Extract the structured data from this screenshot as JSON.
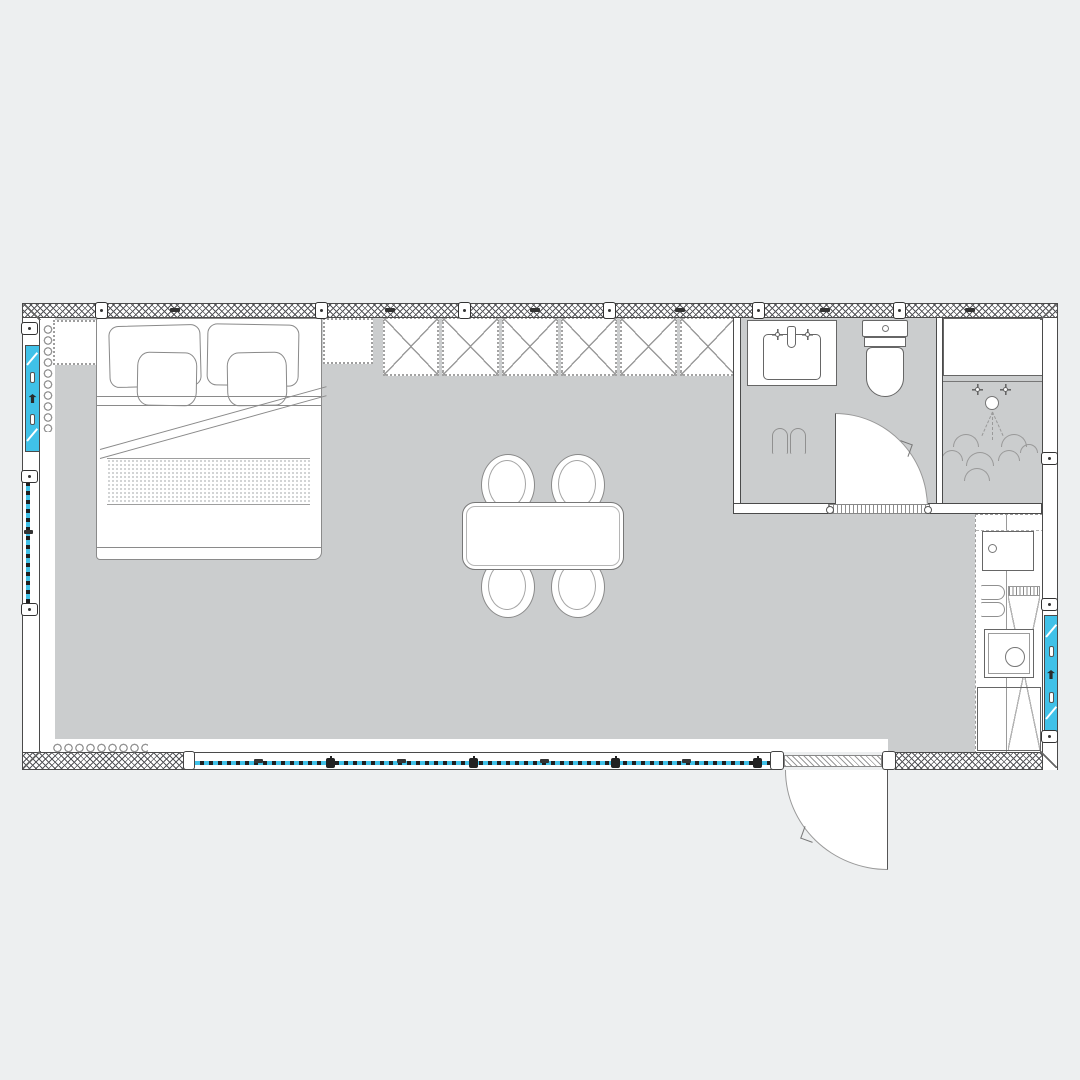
{
  "app": {
    "type": "architectural-floor-plan",
    "description": "Top-down studio / container-home floor plan with bedroom-living area, bathroom, shower room and kitchen strip"
  },
  "colors": {
    "page_bg": "#edeff0",
    "floor_fill": "#cbcdce",
    "window_accent": "#40c1e8",
    "wall_line": "#4a4a4a",
    "furniture_line": "#8a8a8a"
  },
  "rooms": [
    {
      "name": "main-room",
      "contents": [
        "double-bed",
        "nightstand-left",
        "nightstand-right",
        "wardrobe",
        "dining-table",
        "four-chairs",
        "radiator-left",
        "radiator-bottom"
      ]
    },
    {
      "name": "bathroom",
      "contents": [
        "washbasin",
        "toilet",
        "slippers",
        "inward-door"
      ]
    },
    {
      "name": "shower-room",
      "contents": [
        "shower-tray",
        "shower-head"
      ]
    },
    {
      "name": "kitchen-strip",
      "contents": [
        "cooktop",
        "kitchen-sink",
        "tall-unit",
        "base-cabinet",
        "slippers"
      ]
    }
  ],
  "wardrobe": {
    "sections": 6
  },
  "dining": {
    "chairs": [
      {
        "x": 481,
        "y": 454
      },
      {
        "x": 551,
        "y": 454
      },
      {
        "x": 481,
        "y": 556
      },
      {
        "x": 551,
        "y": 556
      }
    ]
  },
  "windows": {
    "left_fixed_window": true,
    "right_fixed_window": true,
    "bottom_band_mullions_x": [
      135,
      278,
      420,
      562
    ],
    "bottom_band_ticks_x": [
      63,
      206,
      349,
      491
    ]
  },
  "wall_joints": {
    "top_x": [
      95,
      315,
      458,
      603,
      752,
      893
    ],
    "top_ticks_x": [
      170,
      385,
      530,
      675,
      820,
      965
    ],
    "left_y": [
      322,
      470,
      603
    ],
    "right_y": [
      452,
      598,
      730
    ]
  },
  "shower_scallops": [
    {
      "x": 953,
      "y": 434,
      "w": 26
    },
    {
      "x": 1001,
      "y": 434,
      "w": 26
    },
    {
      "x": 941,
      "y": 450,
      "w": 22
    },
    {
      "x": 966,
      "y": 452,
      "w": 28
    },
    {
      "x": 998,
      "y": 450,
      "w": 22
    },
    {
      "x": 1020,
      "y": 444,
      "w": 18
    },
    {
      "x": 964,
      "y": 468,
      "w": 26
    }
  ],
  "doors": [
    {
      "name": "entry-door",
      "swing": "outward"
    },
    {
      "name": "bathroom-door",
      "swing": "inward"
    }
  ]
}
